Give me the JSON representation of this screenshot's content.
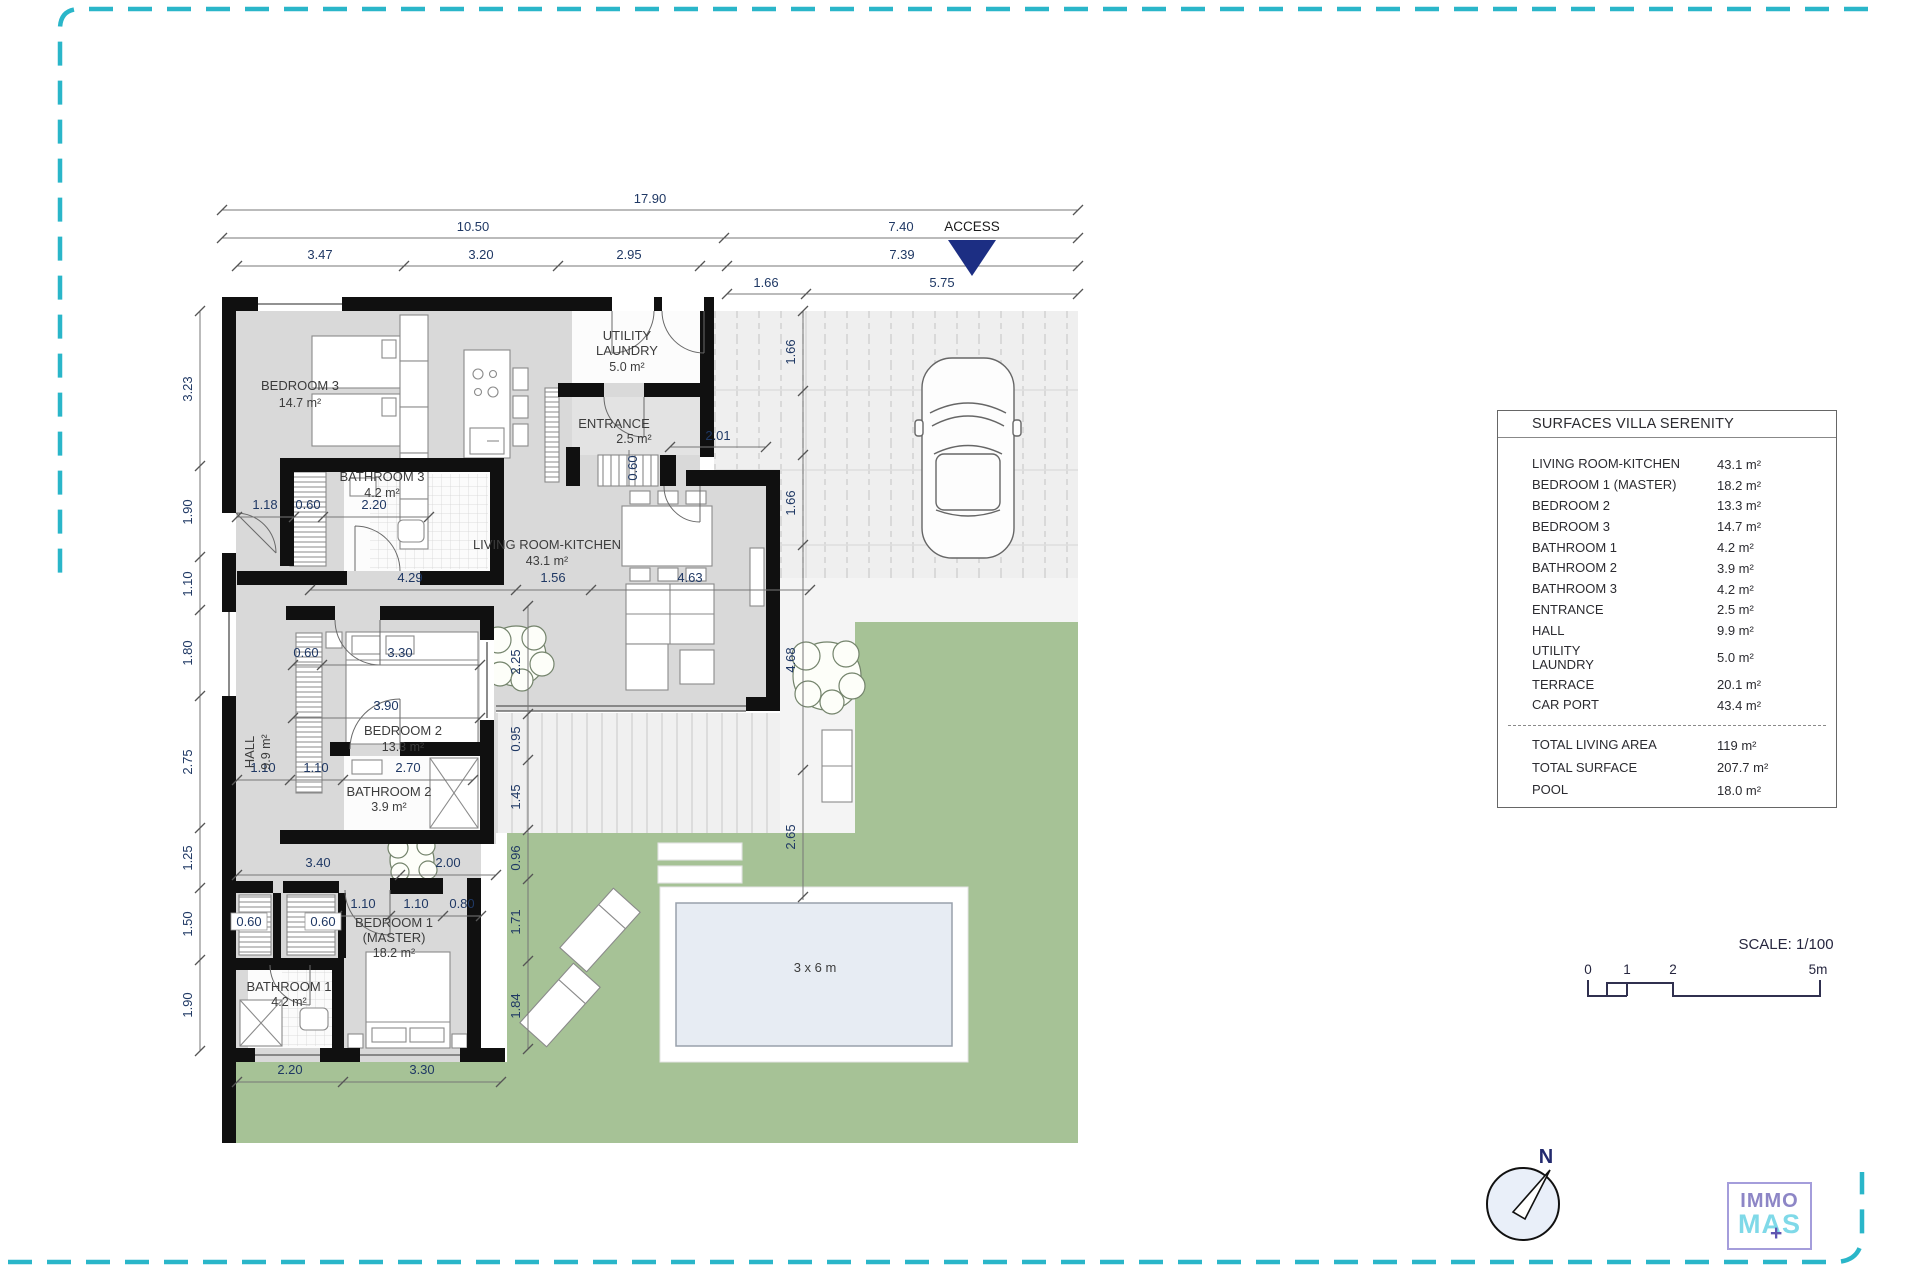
{
  "frame_color": "#2ab6c9",
  "access": {
    "label": "ACCESS"
  },
  "pool": {
    "label": "3 x 6 m"
  },
  "north": {
    "label": "N"
  },
  "scale": {
    "label": "SCALE: 1/100",
    "t0": "0",
    "t1": "1",
    "t2": "2",
    "t5": "5m"
  },
  "logo": {
    "top": "IMMO",
    "bottom": "MAS",
    "plus": "+"
  },
  "rooms": {
    "bedroom3": {
      "name": "BEDROOM 3",
      "area": "14.7 m²"
    },
    "bathroom3": {
      "name": "BATHROOM 3",
      "area": "4.2 m²"
    },
    "utility": {
      "l1": "UTILITY",
      "l2": "LAUNDRY",
      "area": "5.0 m²"
    },
    "entrance": {
      "name": "ENTRANCE",
      "area": "2.5 m²"
    },
    "living": {
      "name": "LIVING ROOM-KITCHEN",
      "area": "43.1 m²"
    },
    "hall": {
      "name": "HALL",
      "area": "9.9 m²"
    },
    "bedroom2": {
      "name": "BEDROOM 2",
      "area": "13.3 m²"
    },
    "bathroom2": {
      "name": "BATHROOM 2",
      "area": "3.9 m²"
    },
    "bedroom1": {
      "l1": "BEDROOM 1",
      "l2": "(MASTER)",
      "area": "18.2 m²"
    },
    "bathroom1": {
      "name": "BATHROOM 1",
      "area": "4.2 m²"
    }
  },
  "dims": {
    "t1": "17.90",
    "t2": "10.50",
    "t3": "7.40",
    "t4": "3.47",
    "t5": "3.20",
    "t6": "2.95",
    "t7": "7.39",
    "t8": "1.66",
    "t9": "5.75",
    "l1": "3.23",
    "l2": "1.90",
    "l3": "1.10",
    "l4": "1.80",
    "l5": "2.75",
    "l6": "1.25",
    "l7": "1.50",
    "l8": "1.90",
    "c1": "1.66",
    "c2": "1.66",
    "c3": "4.68",
    "c4": "2.65",
    "e1": "2.01",
    "e2": "0.60",
    "b3a": "1.18",
    "b3b": "0.60",
    "b3c": "2.20",
    "lv1": "4.29",
    "lv2": "1.56",
    "lv3": "4.63",
    "bd2a": "0.60",
    "bd2b": "3.30",
    "bd2c": "3.90",
    "ct": "2.25",
    "rv1": "0.95",
    "rv2": "1.45",
    "rv3": "0.96",
    "rv4": "1.71",
    "rv5": "1.84",
    "ba2a": "1.10",
    "ba2b": "1.10",
    "ba2c": "2.70",
    "h1": "3.40",
    "h2": "2.00",
    "bd1a": "1.10",
    "bd1b": "1.10",
    "bd1c": "0.80",
    "cl1": "0.60",
    "cl2": "0.60",
    "bt1": "2.20",
    "bt2": "3.30"
  },
  "table": {
    "title": "SURFACES VILLA SERENITY",
    "rows": [
      {
        "label": "LIVING ROOM-KITCHEN",
        "value": "43.1 m²"
      },
      {
        "label": "BEDROOM 1 (MASTER)",
        "value": "18.2 m²"
      },
      {
        "label": "BEDROOM 2",
        "value": "13.3 m²"
      },
      {
        "label": "BEDROOM 3",
        "value": "14.7 m²"
      },
      {
        "label": "BATHROOM 1",
        "value": "4.2 m²"
      },
      {
        "label": "BATHROOM 2",
        "value": "3.9 m²"
      },
      {
        "label": "BATHROOM 3",
        "value": "4.2 m²"
      },
      {
        "label": "ENTRANCE",
        "value": "2.5 m²"
      },
      {
        "label": "HALL",
        "value": "9.9 m²"
      },
      {
        "l1": "UTILITY",
        "l2": "LAUNDRY",
        "value": "5.0 m²"
      },
      {
        "label": "TERRACE",
        "value": "20.1 m²"
      },
      {
        "label": "CAR PORT",
        "value": "43.4 m²"
      }
    ],
    "totals": [
      {
        "label": "TOTAL LIVING AREA",
        "value": "119 m²"
      },
      {
        "label": "TOTAL SURFACE",
        "value": "207.7 m²"
      },
      {
        "label": "POOL",
        "value": "18.0 m²"
      }
    ]
  }
}
